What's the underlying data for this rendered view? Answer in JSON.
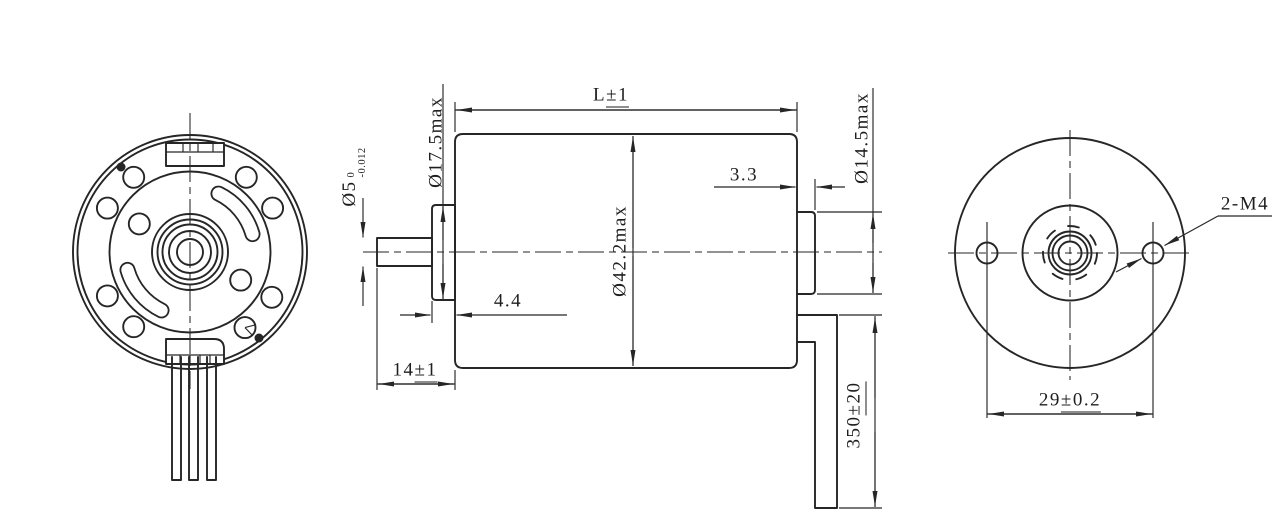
{
  "drawing": {
    "background": "#ffffff",
    "line_color": "#262626",
    "dimensions": {
      "shaft_diameter": {
        "value": "Ø5",
        "tol_upper": "0",
        "tol_lower": "-0.012"
      },
      "front_boss_diameter": {
        "value": "Ø17.5max"
      },
      "body_length": {
        "value": "L",
        "tolerance": "±1"
      },
      "body_diameter": {
        "value": "Ø42.2max"
      },
      "rear_step_length": {
        "value": "3.3"
      },
      "rear_boss_diameter": {
        "value": "Ø14.5max"
      },
      "flange_thickness": {
        "value": "4.4"
      },
      "shaft_extension": {
        "value": "14",
        "tolerance": "±1"
      },
      "cable_length": {
        "value": "350",
        "tolerance": "±20"
      },
      "mounting_holes": {
        "value": "2-M4"
      },
      "hole_spacing": {
        "value": "29",
        "tolerance": "±0.2"
      }
    }
  }
}
